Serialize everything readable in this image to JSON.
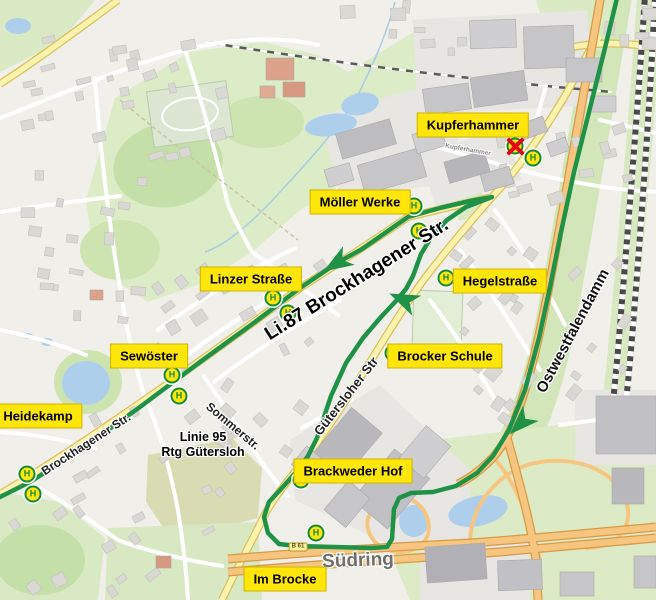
{
  "map": {
    "colors": {
      "background": "#f0efe9",
      "route_green": "#1f9247",
      "stop_yellow": "#ffe60a",
      "stop_ring_green": "#128a3e",
      "closed_red": "#e30613",
      "label_bg": "#ffe60a",
      "label_text": "#000000",
      "motorway_orange": "#f6c680",
      "main_road_yellow": "#fcf3ae",
      "water_blue": "#aecfeb",
      "park_green": "#dcecc6"
    },
    "stop_icon_letter": "H",
    "route": {
      "color": "#1f9247",
      "width": 4.5,
      "points": [
        [
          618,
          -6
        ],
        [
          604,
          52
        ],
        [
          589,
          112
        ],
        [
          574,
          172
        ],
        [
          561,
          232
        ],
        [
          550,
          287
        ],
        [
          539,
          338
        ],
        [
          525,
          390
        ],
        [
          509,
          430
        ],
        [
          493,
          456
        ],
        [
          477,
          473
        ],
        [
          456,
          486
        ],
        [
          433,
          492
        ],
        [
          411,
          493
        ],
        [
          399,
          498
        ],
        [
          394,
          509
        ],
        [
          392,
          539
        ],
        [
          387,
          547
        ],
        [
          371,
          548
        ],
        [
          297,
          546
        ],
        [
          279,
          544
        ],
        [
          268,
          533
        ],
        [
          264,
          517
        ],
        [
          269,
          502
        ],
        [
          281,
          489
        ],
        [
          297,
          471
        ],
        [
          308,
          456
        ],
        [
          317,
          438
        ],
        [
          331,
          396
        ],
        [
          346,
          363
        ],
        [
          363,
          338
        ],
        [
          381,
          317
        ],
        [
          396,
          301
        ],
        [
          406,
          289
        ],
        [
          413,
          276
        ],
        [
          421,
          254
        ],
        [
          432,
          236
        ],
        [
          447,
          220
        ],
        [
          466,
          207
        ],
        [
          492,
          197
        ],
        [
          470,
          201
        ],
        [
          440,
          208
        ],
        [
          408,
          217
        ],
        [
          362,
          249
        ],
        [
          337,
          263
        ],
        [
          300,
          288
        ],
        [
          255,
          322
        ],
        [
          200,
          362
        ],
        [
          140,
          407
        ],
        [
          80,
          450
        ],
        [
          30,
          482
        ],
        [
          -6,
          500
        ]
      ],
      "arrows": [
        {
          "x": 337,
          "y": 263,
          "angle": 148
        },
        {
          "x": 404,
          "y": 300,
          "angle": 204
        },
        {
          "x": 521,
          "y": 423,
          "angle": 135
        }
      ]
    },
    "stops": [
      {
        "x": 515,
        "y": 146,
        "closed": true
      },
      {
        "x": 533,
        "y": 158,
        "closed": false
      },
      {
        "x": 414,
        "y": 206,
        "closed": false
      },
      {
        "x": 419,
        "y": 231,
        "closed": false
      },
      {
        "x": 446,
        "y": 278,
        "closed": false
      },
      {
        "x": 273,
        "y": 298,
        "closed": false
      },
      {
        "x": 288,
        "y": 313,
        "closed": false
      },
      {
        "x": 172,
        "y": 375,
        "closed": false
      },
      {
        "x": 179,
        "y": 396,
        "closed": false
      },
      {
        "x": 27,
        "y": 474,
        "closed": false
      },
      {
        "x": 33,
        "y": 494,
        "closed": false
      },
      {
        "x": 393,
        "y": 353,
        "closed": false
      },
      {
        "x": 301,
        "y": 480,
        "closed": false
      },
      {
        "x": 316,
        "y": 533,
        "closed": false
      }
    ],
    "stop_labels": [
      {
        "text": "Kupferhammer",
        "x": 473,
        "y": 125
      },
      {
        "text": "Möller Werke",
        "x": 360,
        "y": 202
      },
      {
        "text": "Linzer Straße",
        "x": 251,
        "y": 279
      },
      {
        "text": "Hegelstraße",
        "x": 500,
        "y": 281
      },
      {
        "text": "Sewöster",
        "x": 149,
        "y": 356
      },
      {
        "text": "Brocker Schule",
        "x": 445,
        "y": 356
      },
      {
        "text": "Heidekamp",
        "x": 38,
        "y": 416
      },
      {
        "text": "Brackweder Hof",
        "x": 353,
        "y": 471
      },
      {
        "text": "Im Brocke",
        "x": 285,
        "y": 579
      }
    ],
    "map_texts": [
      {
        "text": "Li.87 Brockhagener Str.",
        "x": 357,
        "y": 280,
        "rot": -32,
        "size": 19,
        "color": "#000000"
      },
      {
        "text": "Ostwestfalendamm",
        "x": 573,
        "y": 331,
        "rot": -62,
        "size": 15,
        "color": "#111111"
      },
      {
        "text": "Brockhagener Str.",
        "x": 86,
        "y": 444,
        "rot": -33,
        "size": 12,
        "color": "#222222"
      },
      {
        "text": "Sommerstr.",
        "x": 233,
        "y": 426,
        "rot": 40,
        "size": 12,
        "color": "#222222"
      },
      {
        "text": "Gütersloher Str",
        "x": 346,
        "y": 396,
        "rot": -52,
        "size": 13,
        "color": "#222222"
      },
      {
        "text": "Südring",
        "x": 358,
        "y": 561,
        "rot": -2,
        "size": 19,
        "color": "#6f6f6f"
      },
      {
        "text": "Linie 95",
        "x": 203,
        "y": 437,
        "rot": 0,
        "size": 12.5,
        "color": "#000000"
      },
      {
        "text": "Rtg Gütersloh",
        "x": 203,
        "y": 452,
        "rot": 0,
        "size": 12.5,
        "color": "#000000"
      },
      {
        "text": "Kupferhammer",
        "x": 468,
        "y": 150,
        "rot": 10,
        "size": 6.5,
        "color": "#888888"
      }
    ],
    "road_shield": {
      "text": "B 61",
      "x": 298,
      "y": 547
    }
  }
}
